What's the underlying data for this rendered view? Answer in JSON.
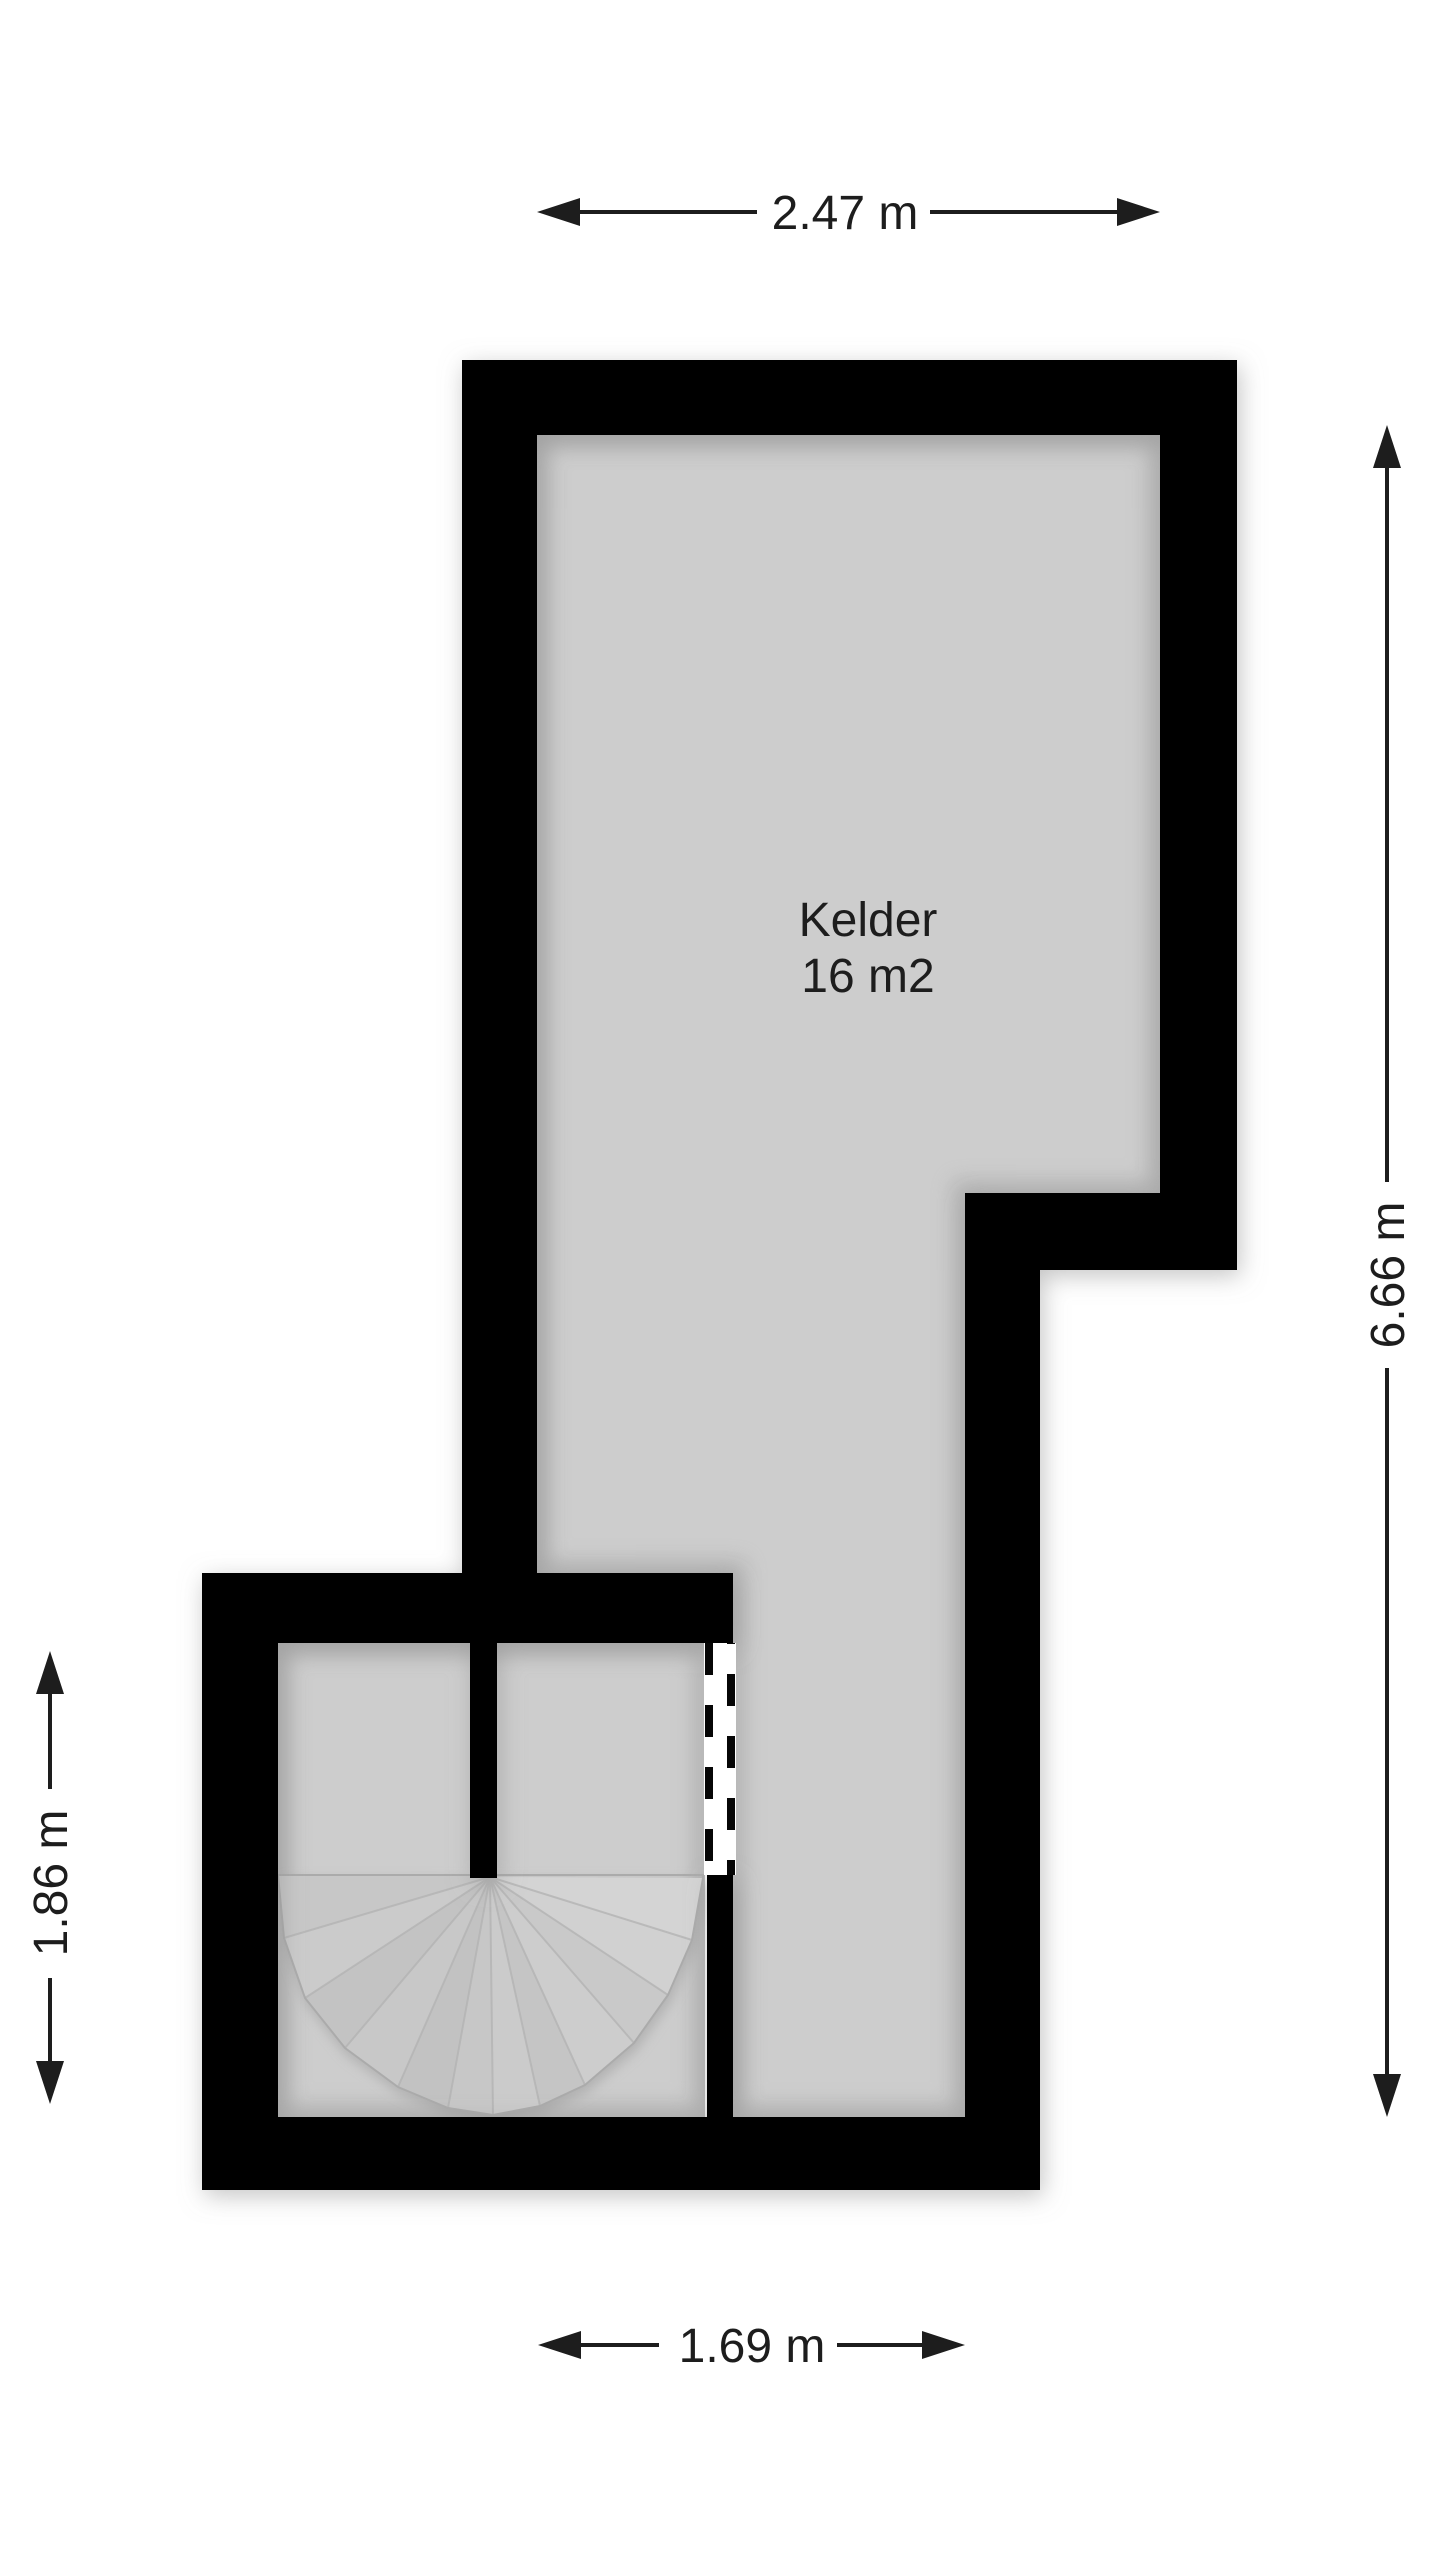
{
  "floorplan": {
    "room": {
      "name": "Kelder",
      "area": "16 m2"
    },
    "dimensions": {
      "top": "2.47 m",
      "right": "6.66 m",
      "left": "1.86 m",
      "bottom": "1.69 m"
    },
    "features": {
      "stair": "spiral-stair-fan",
      "opening": "dashed-door-opening"
    },
    "colors": {
      "background": "#ffffff",
      "wall": "#060606",
      "floor": "#cdcdcd",
      "stair_fill": "#c8c8c8",
      "dimension_text": "#1d1d1d"
    }
  }
}
